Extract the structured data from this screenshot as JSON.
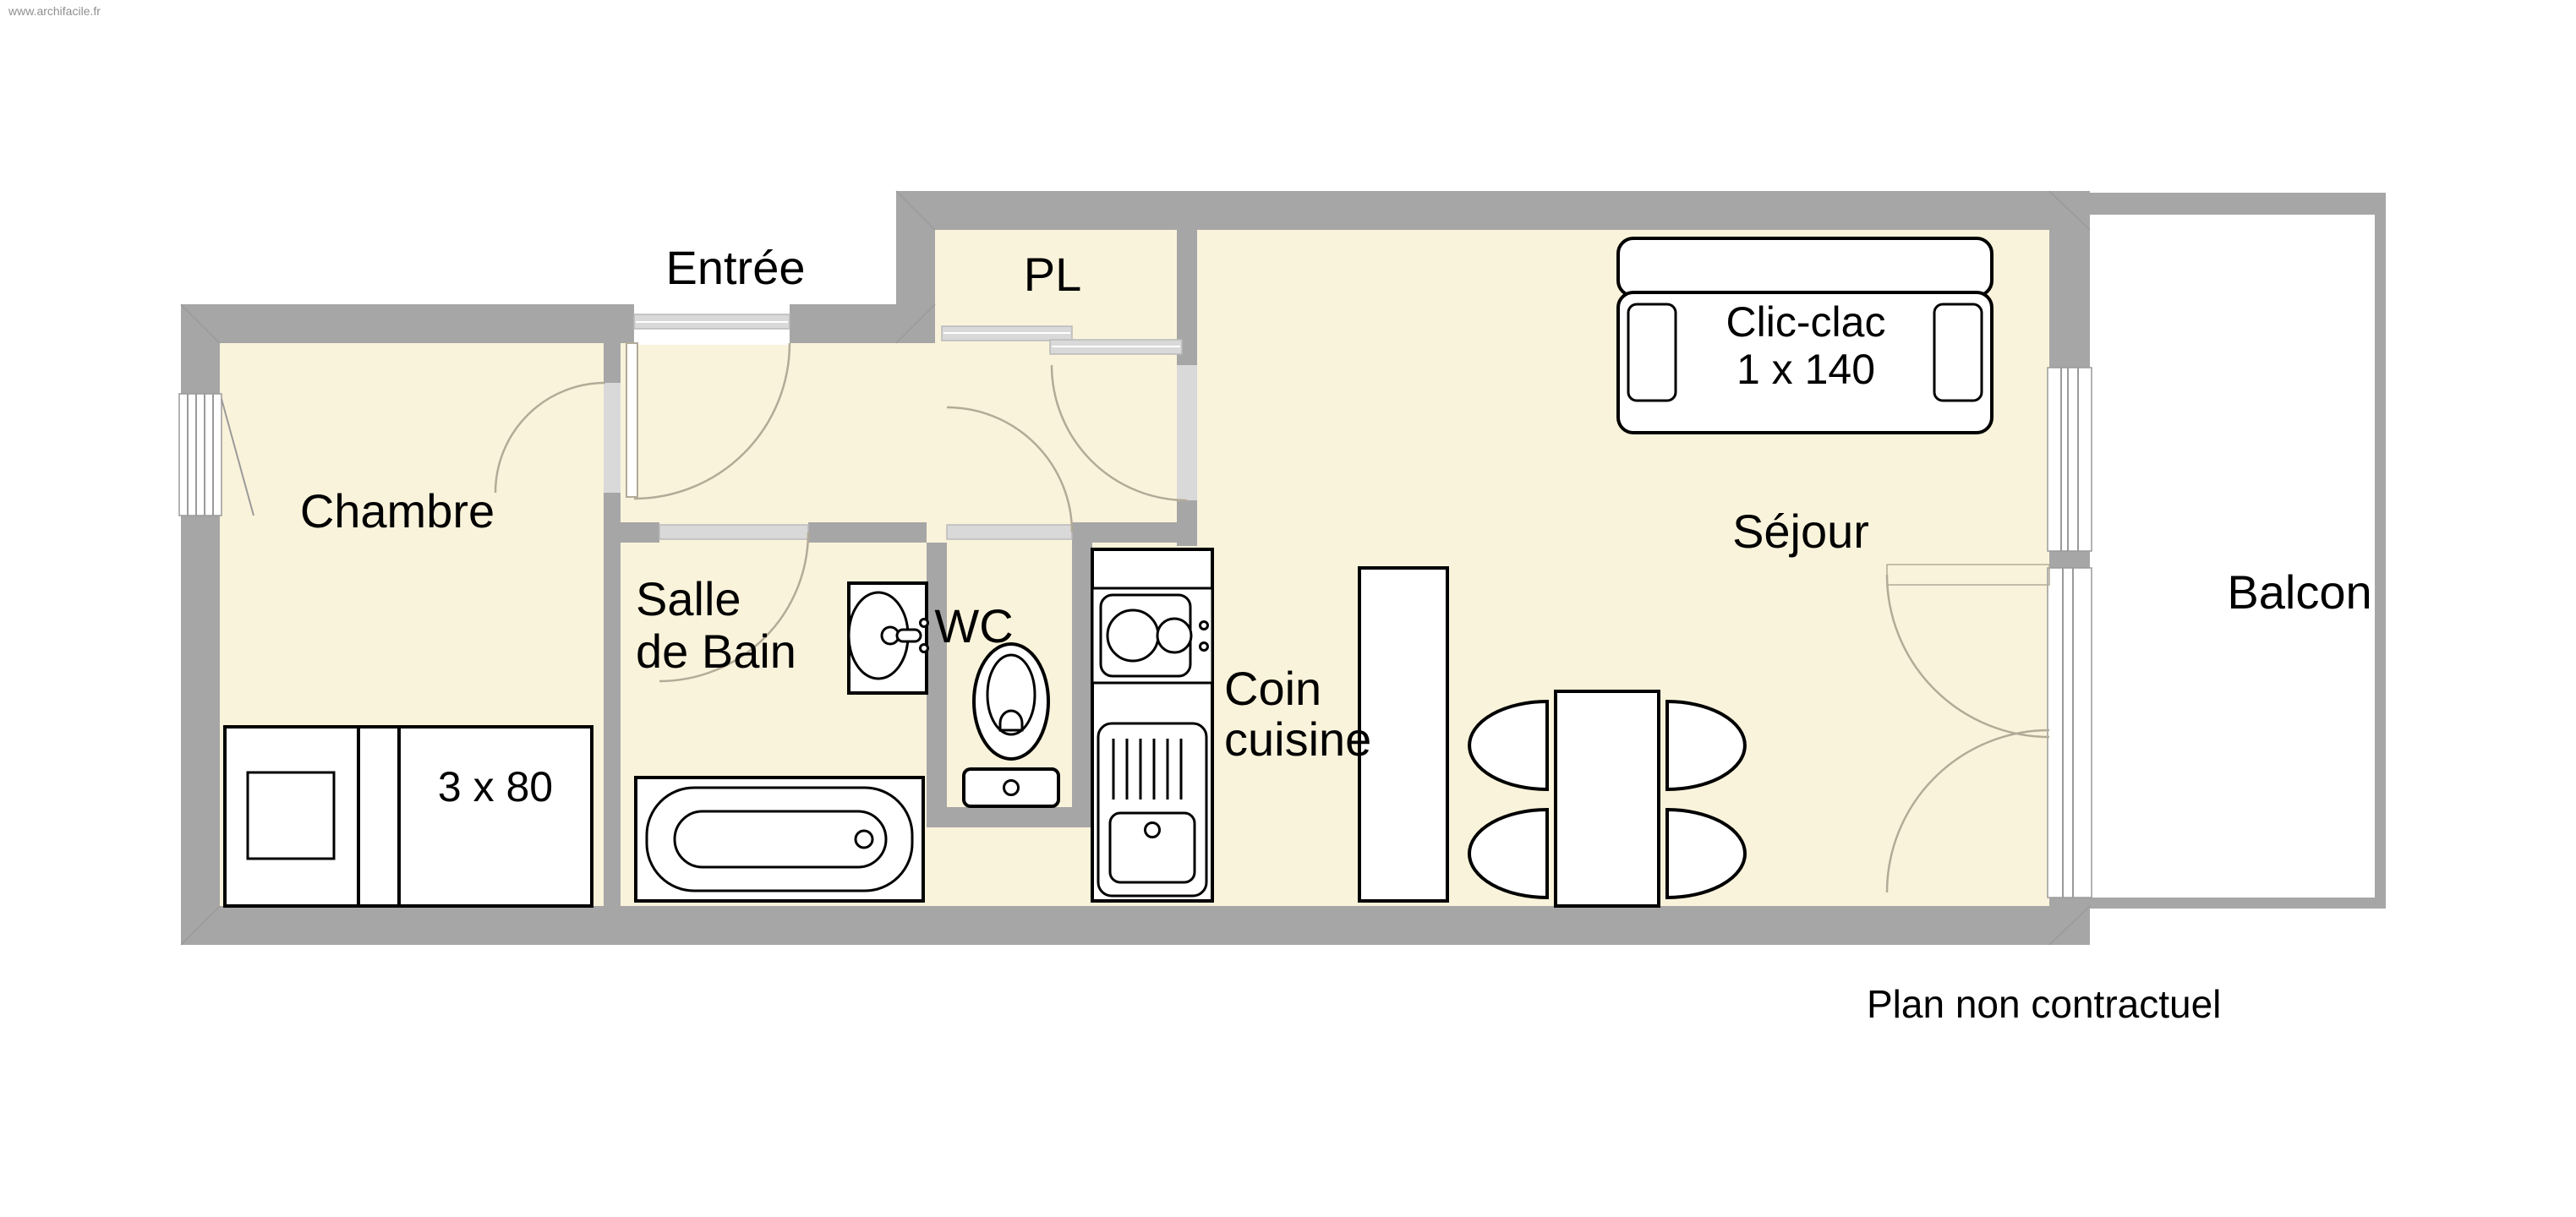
{
  "meta": {
    "watermark": "www.archifacile.fr",
    "plan_note": "Plan non contractuel"
  },
  "rooms": {
    "entree": "Entrée",
    "pl": "PL",
    "chambre": "Chambre",
    "salle_de_bain_line1": "Salle",
    "salle_de_bain_line2": "de Bain",
    "wc": "WC",
    "coin_cuisine_line1": "Coin",
    "coin_cuisine_line2": "cuisine",
    "sejour": "Séjour",
    "balcon": "Balcon"
  },
  "furniture": {
    "sofa_line1": "Clic-clac",
    "sofa_line2": "1 x 140",
    "bed_label": "3 x 80"
  },
  "colors": {
    "floor": "#faf3db",
    "wall": "#a6a6a6",
    "door_leaf": "#d9d9d9",
    "door_arc": "#b3aa97",
    "balcony_floor": "#ffffff",
    "furniture_outline": "#000000",
    "watermark_text": "#8f8f8f"
  }
}
